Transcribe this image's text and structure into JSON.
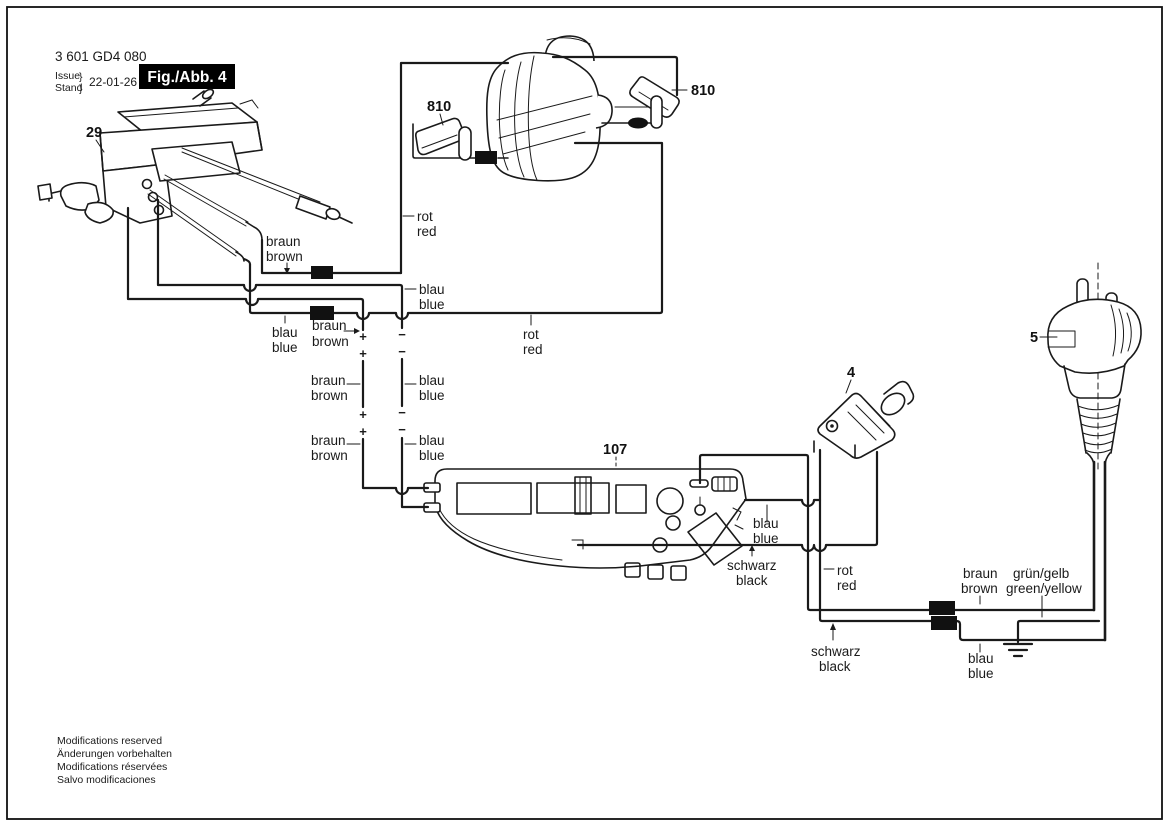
{
  "header": {
    "part_number": "3 601 GD4 080",
    "issue": "Issue",
    "stand": "Stand",
    "brace": "}",
    "date": "22-01-26",
    "figure": "Fig./Abb. 4"
  },
  "parts": {
    "switch": "29",
    "brush_left": "810",
    "armature": "2",
    "brush_right": "810",
    "connector": "4",
    "plug": "5",
    "module": "107"
  },
  "wires": {
    "rot": {
      "de": "rot",
      "en": "red"
    },
    "braun": {
      "de": "braun",
      "en": "brown"
    },
    "blau": {
      "de": "blau",
      "en": "blue"
    },
    "schwarz": {
      "de": "schwarz",
      "en": "black"
    },
    "gruen_gelb": {
      "de": "grün/gelb",
      "en": "green/yellow"
    }
  },
  "polarity": {
    "plus": "+",
    "minus": "−"
  },
  "footer": {
    "lines": [
      "Modifications reserved",
      "Änderungen vorbehalten",
      "Modifications réservées",
      "Salvo modificaciones"
    ]
  },
  "colors": {
    "ink": "#1a1a1a",
    "background": "#ffffff",
    "figure_box_bg": "#000000",
    "figure_box_text": "#ffffff"
  }
}
